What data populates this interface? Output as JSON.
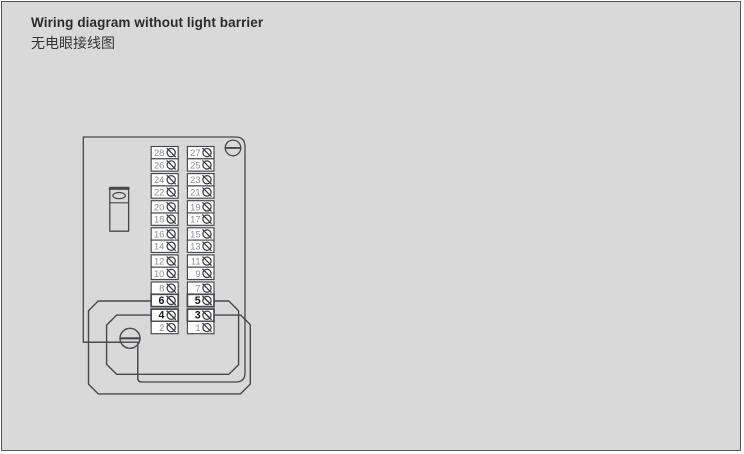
{
  "page": {
    "background_color": "#d9d9d9",
    "border_color": "#55575c",
    "line_color": "#46484c"
  },
  "header": {
    "title": "Wiring diagram without light barrier",
    "subtitle": "无电眼接线图"
  },
  "diagram": {
    "board": {
      "fill": "#ffffff"
    },
    "colors": {
      "number_muted": "#8d8f92",
      "number_bold": "#141414",
      "wire_fill": "#d9d9d9"
    },
    "screws": {
      "top_right": "flat-head-screw",
      "bottom_left": "flat-head-screw"
    },
    "terminal_strip": {
      "left_column": [
        {
          "label": "28",
          "bold": false
        },
        {
          "label": "26",
          "bold": false
        },
        {
          "label": "24",
          "bold": false
        },
        {
          "label": "22",
          "bold": false
        },
        {
          "label": "20",
          "bold": false
        },
        {
          "label": "18",
          "bold": false
        },
        {
          "label": "16",
          "bold": false
        },
        {
          "label": "14",
          "bold": false
        },
        {
          "label": "12",
          "bold": false
        },
        {
          "label": "10",
          "bold": false
        },
        {
          "label": "8",
          "bold": false
        },
        {
          "label": "6",
          "bold": true
        },
        {
          "label": "4",
          "bold": true
        },
        {
          "label": "2",
          "bold": false
        }
      ],
      "right_column": [
        {
          "label": "27",
          "bold": false
        },
        {
          "label": "25",
          "bold": false
        },
        {
          "label": "23",
          "bold": false
        },
        {
          "label": "21",
          "bold": false
        },
        {
          "label": "19",
          "bold": false
        },
        {
          "label": "17",
          "bold": false
        },
        {
          "label": "15",
          "bold": false
        },
        {
          "label": "13",
          "bold": false
        },
        {
          "label": "11",
          "bold": false
        },
        {
          "label": "9",
          "bold": false
        },
        {
          "label": "7",
          "bold": false
        },
        {
          "label": "5",
          "bold": true
        },
        {
          "label": "3",
          "bold": true
        },
        {
          "label": "1",
          "bold": false
        }
      ]
    },
    "wires": {
      "outer_loop": "terminal-6-to-terminal-3",
      "inner_loop": "terminal-4-to-terminal-5"
    }
  }
}
